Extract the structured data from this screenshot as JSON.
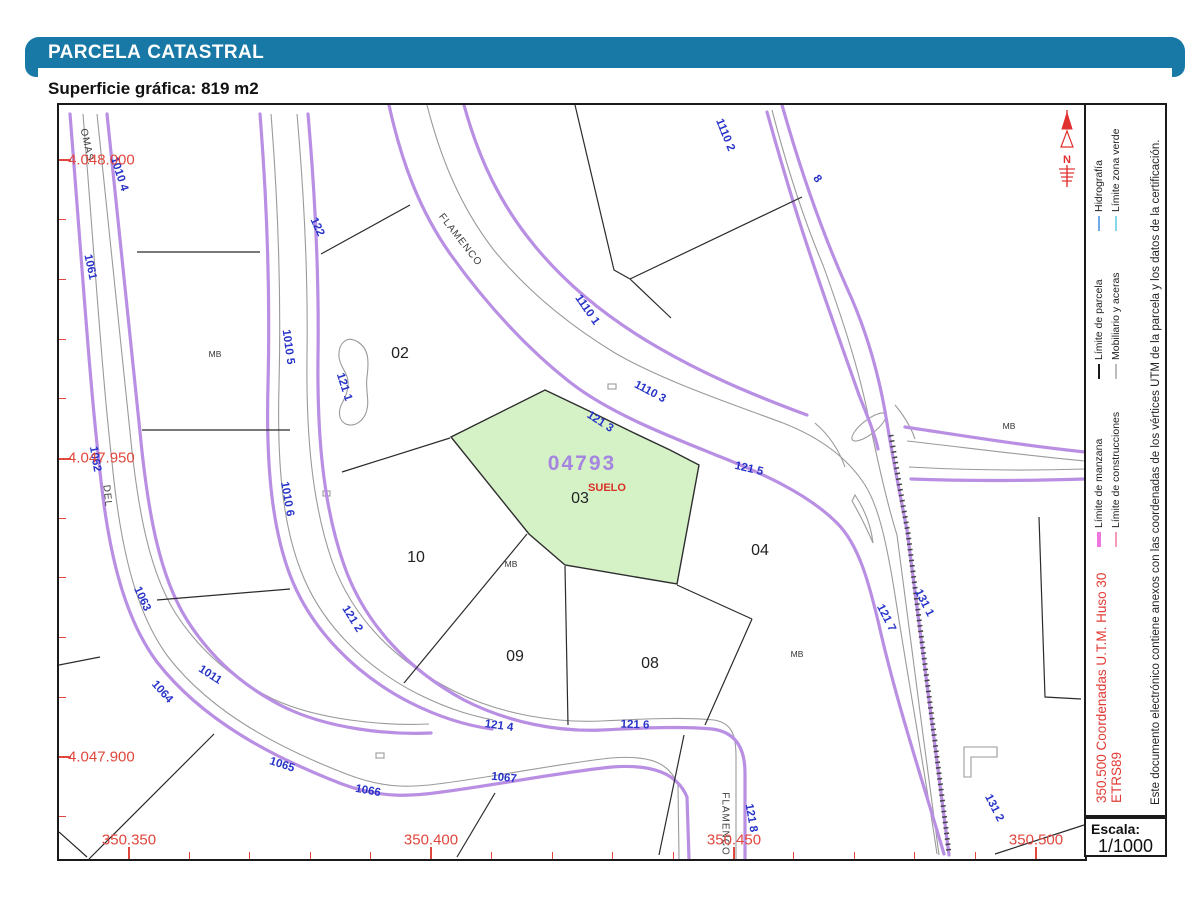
{
  "header": {
    "title_primary": "PARCELA",
    "title_secondary": "CATASTRAL",
    "surface_label": "Superficie gráfica:",
    "surface_value": "819 m2"
  },
  "map": {
    "highlight": {
      "parcel_code": "04793",
      "land_use": "SUELO",
      "parcel_number": "03",
      "fill_color": "#d5f2c7"
    },
    "north_label": "N",
    "parcel_numbers": [
      {
        "text": "02",
        "x": 341,
        "y": 249
      },
      {
        "text": "10",
        "x": 357,
        "y": 453
      },
      {
        "text": "09",
        "x": 456,
        "y": 552
      },
      {
        "text": "08",
        "x": 591,
        "y": 559
      },
      {
        "text": "04",
        "x": 701,
        "y": 446
      }
    ],
    "construction_labels": [
      {
        "text": "MB",
        "x": 156,
        "y": 249
      },
      {
        "text": "MB",
        "x": 452,
        "y": 459
      },
      {
        "text": "MB",
        "x": 738,
        "y": 549
      },
      {
        "text": "MB",
        "x": 950,
        "y": 321
      }
    ],
    "street_labels": [
      {
        "text": "OMAS.",
        "x": 28,
        "y": 42,
        "r": 78
      },
      {
        "text": "DEL",
        "x": 48,
        "y": 391,
        "r": 84
      },
      {
        "text": "FLAMENCO",
        "x": 401,
        "y": 135,
        "r": 52
      },
      {
        "text": "FLAMENCO",
        "x": 666,
        "y": 719,
        "r": 90
      }
    ],
    "blue_labels": [
      {
        "text": "1110 2",
        "x": 666,
        "y": 30,
        "r": 68
      },
      {
        "text": "8",
        "x": 758,
        "y": 74,
        "r": 55
      },
      {
        "text": "1110 1",
        "x": 528,
        "y": 205,
        "r": 55
      },
      {
        "text": "1110 3",
        "x": 591,
        "y": 287,
        "r": 28
      },
      {
        "text": "121 3",
        "x": 541,
        "y": 317,
        "r": 33
      },
      {
        "text": "121 5",
        "x": 690,
        "y": 364,
        "r": 13
      },
      {
        "text": "121 1",
        "x": 285,
        "y": 282,
        "r": 72
      },
      {
        "text": "122",
        "x": 258,
        "y": 122,
        "r": 65
      },
      {
        "text": "1010 4",
        "x": 60,
        "y": 69,
        "r": 72
      },
      {
        "text": "1061",
        "x": 31,
        "y": 162,
        "r": 78
      },
      {
        "text": "1010 5",
        "x": 229,
        "y": 242,
        "r": 82
      },
      {
        "text": "1062",
        "x": 36,
        "y": 354,
        "r": 80
      },
      {
        "text": "1010 6",
        "x": 228,
        "y": 394,
        "r": 80
      },
      {
        "text": "1063",
        "x": 83,
        "y": 494,
        "r": 65
      },
      {
        "text": "121 2",
        "x": 293,
        "y": 514,
        "r": 58
      },
      {
        "text": "1064",
        "x": 103,
        "y": 587,
        "r": 48
      },
      {
        "text": "1011",
        "x": 151,
        "y": 570,
        "r": 33
      },
      {
        "text": "1065",
        "x": 223,
        "y": 660,
        "r": 18
      },
      {
        "text": "1066",
        "x": 309,
        "y": 686,
        "r": 10
      },
      {
        "text": "1067",
        "x": 445,
        "y": 673,
        "r": 6
      },
      {
        "text": "121 4",
        "x": 440,
        "y": 621,
        "r": 8
      },
      {
        "text": "121 6",
        "x": 576,
        "y": 620,
        "r": 2
      },
      {
        "text": "121 8",
        "x": 692,
        "y": 713,
        "r": 80
      },
      {
        "text": "121 7",
        "x": 827,
        "y": 513,
        "r": 63
      },
      {
        "text": "131 1",
        "x": 865,
        "y": 498,
        "r": 63
      },
      {
        "text": "131 2",
        "x": 935,
        "y": 703,
        "r": 63
      }
    ],
    "grid_left": [
      {
        "text": "4.048.000",
        "y": 55
      },
      {
        "text": "4.047.950",
        "y": 353
      },
      {
        "text": "4.047.900",
        "y": 652
      }
    ],
    "grid_bottom": [
      {
        "text": "350.350",
        "x": 70
      },
      {
        "text": "350.400",
        "x": 372
      },
      {
        "text": "350.450",
        "x": 675
      },
      {
        "text": "350.500",
        "x": 977
      }
    ]
  },
  "legend": {
    "row1": [
      {
        "label": "Límite de manzana",
        "color": "#ee76dd",
        "thick": true
      },
      {
        "label": "Límite de parcela",
        "color": "#1a1a1a",
        "thick": false
      },
      {
        "label": "Hidrografía",
        "color": "#6fa9e8",
        "thick": false
      }
    ],
    "row2": [
      {
        "label": "Límite de construcciones",
        "color": "#f29ab6",
        "thick": false
      },
      {
        "label": "Mobiliario y aceras",
        "color": "#bcbcbc",
        "thick": false
      },
      {
        "label": "Límite zona verde",
        "color": "#85d8e8",
        "thick": false
      }
    ],
    "utm_text": "350.500 Coordenadas U.T.M. Huso 30 ETRS89",
    "doc_text": "Este documento electrónico contiene anexos con las coordenadas de los vértices UTM de la parcela y los datos de la certificación."
  },
  "scale": {
    "label": "Escala:",
    "value": "1/1000"
  },
  "colors": {
    "header_bar": "#1878a6",
    "road_edge": "#b98fe4",
    "sidewalk": "#9a9a9a",
    "parcel_line": "#2b2b2b",
    "grid_red": "#e0473d",
    "label_blue": "#2733c8",
    "highlight_green": "#d5f2c7",
    "parcel_code_violet": "#a585e0",
    "north_red": "#e03030"
  }
}
